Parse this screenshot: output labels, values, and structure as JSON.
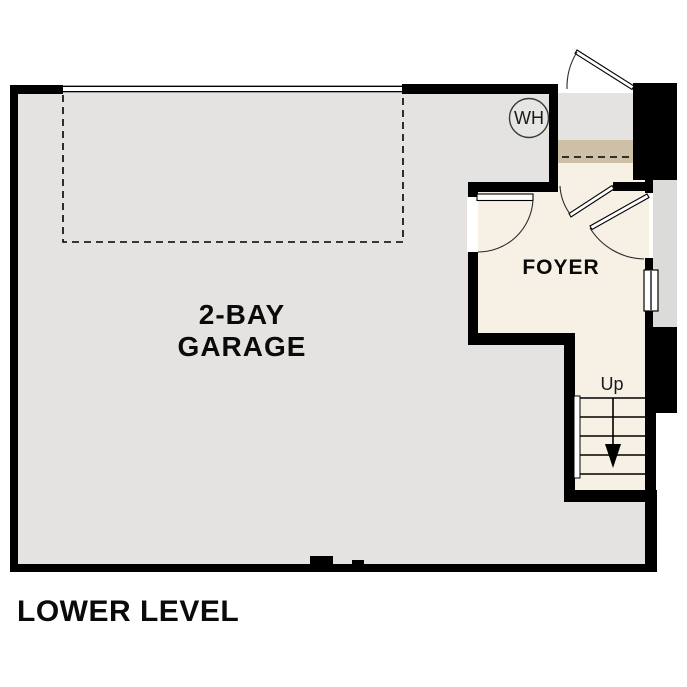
{
  "plan": {
    "title": "LOWER LEVEL",
    "garage": {
      "label_line1": "2-BAY",
      "label_line2": "GARAGE"
    },
    "foyer": {
      "label": "FOYER"
    },
    "stairs": {
      "direction_label": "Up"
    },
    "water_heater": {
      "label": "WH"
    }
  },
  "colors": {
    "floor_gray": "#e4e3e1",
    "room_cream": "#f7f0e4",
    "stair_tan": "#cdc0a7",
    "porch_gray": "#dbdbd9",
    "wh_fill": "#e6e6e4",
    "wall_black": "#000000"
  }
}
